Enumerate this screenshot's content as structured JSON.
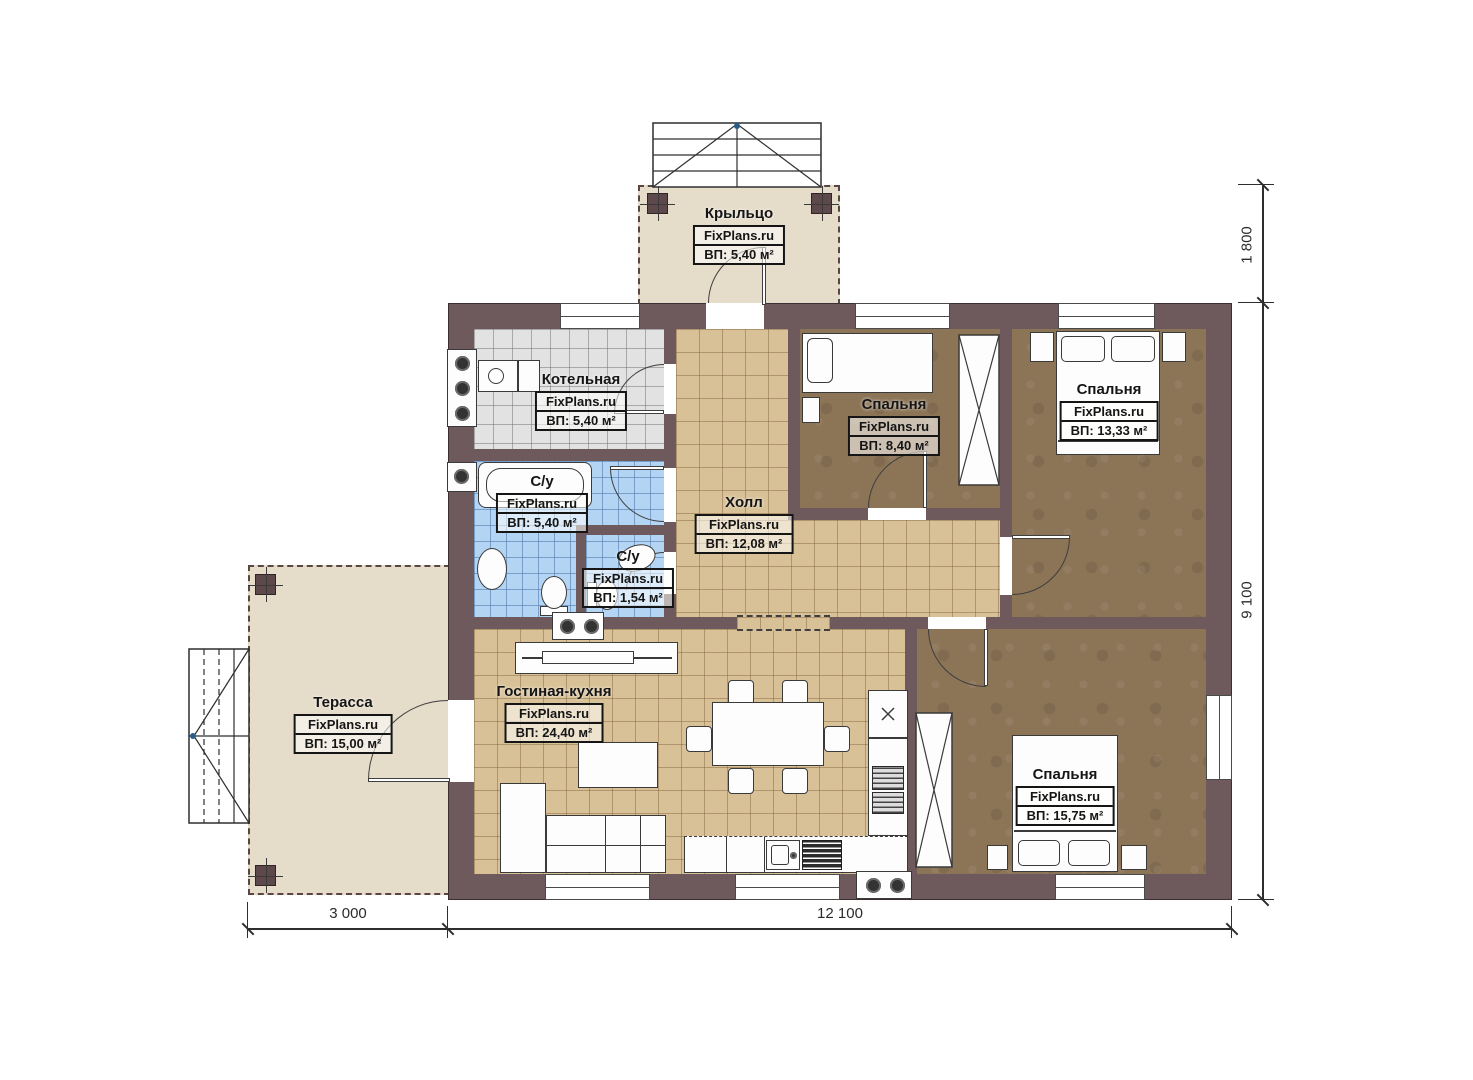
{
  "plan": {
    "brand": "FixPlans.ru",
    "rooms": {
      "porch": {
        "name": "Крыльцо",
        "brand": "FixPlans.ru",
        "area": "ВП: 5,40 м²"
      },
      "boiler": {
        "name": "Котельная",
        "brand": "FixPlans.ru",
        "area": "ВП: 5,40 м²"
      },
      "bathroom": {
        "name": "С/у",
        "brand": "FixPlans.ru",
        "area": "ВП: 5,40 м²"
      },
      "wc": {
        "name": "С/у",
        "brand": "FixPlans.ru",
        "area": "ВП: 1,54 м²"
      },
      "hall": {
        "name": "Холл",
        "brand": "FixPlans.ru",
        "area": "ВП: 12,08 м²"
      },
      "bedroom1": {
        "name": "Спальня",
        "brand": "FixPlans.ru",
        "area": "ВП: 8,40 м²"
      },
      "bedroom2": {
        "name": "Спальня",
        "brand": "FixPlans.ru",
        "area": "ВП: 13,33 м²"
      },
      "terrace": {
        "name": "Терасса",
        "brand": "FixPlans.ru",
        "area": "ВП: 15,00 м²"
      },
      "living": {
        "name": "Гостиная-кухня",
        "brand": "FixPlans.ru",
        "area": "ВП: 24,40 м²"
      },
      "bedroom3": {
        "name": "Спальня",
        "brand": "FixPlans.ru",
        "area": "ВП: 15,75 м²"
      }
    },
    "dimensions": {
      "porch_depth": "1 800",
      "house_height": "9 100",
      "terrace_width": "3 000",
      "house_width": "12 100"
    },
    "colors": {
      "wall": "#6e5a5c",
      "beige_floor": "#e6dcca",
      "tan_tile": "#d8c197",
      "brown_floor": "#8c7457",
      "grey_tile": "#e2e2e2",
      "blue_tile": "#b3d4f2"
    }
  }
}
